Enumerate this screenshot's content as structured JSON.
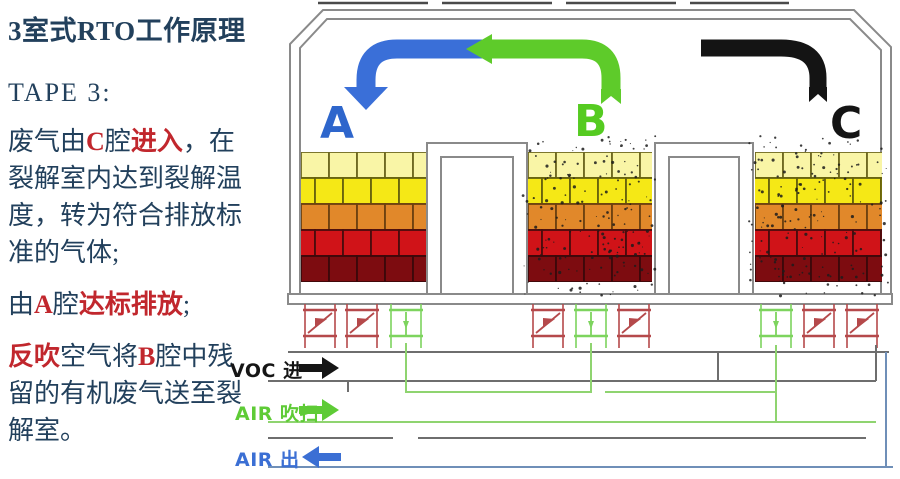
{
  "panel": {
    "title": "3室式RTO工作原理",
    "tape": "TAPE 3:",
    "paragraphs": [
      [
        {
          "t": "废气由"
        },
        {
          "t": "C",
          "red": true
        },
        {
          "t": "腔"
        },
        {
          "t": "进入",
          "red": true
        },
        {
          "t": "，在裂解室内达到裂解温度，转为符合排放标准的气体;"
        }
      ],
      [
        {
          "t": "由"
        },
        {
          "t": "A",
          "red": true
        },
        {
          "t": "腔"
        },
        {
          "t": "达标排放",
          "red": true
        },
        {
          "t": ";"
        }
      ],
      [
        {
          "t": "反吹",
          "red": true
        },
        {
          "t": "空气将"
        },
        {
          "t": "B",
          "red": true
        },
        {
          "t": "腔中残留的有机废气送至裂解室。"
        }
      ]
    ]
  },
  "chambers": [
    {
      "label": "A",
      "color": "#2e66cc",
      "valves": [
        "red",
        "red",
        "green"
      ],
      "dirty": false
    },
    {
      "label": "B",
      "color": "#55cb21",
      "valves": [
        "red",
        "green",
        "red"
      ],
      "dirty": true
    },
    {
      "label": "C",
      "color": "#141414",
      "valves": [
        "green",
        "red",
        "red"
      ],
      "dirty": true
    }
  ],
  "flows": [
    {
      "label": "VOC 进",
      "color": "#151515",
      "dir": "right"
    },
    {
      "label": "AIR 吹扫",
      "color": "#5ecb36",
      "dir": "right"
    },
    {
      "label": "AIR 出",
      "color": "#3b6fd4",
      "dir": "left"
    }
  ],
  "brick_layers": [
    {
      "fill": "#f9f5a6",
      "stroke": "#6e6820"
    },
    {
      "fill": "#f5e816",
      "stroke": "#67620d"
    },
    {
      "fill": "#e1882a",
      "stroke": "#6d4110"
    },
    {
      "fill": "#d01318",
      "stroke": "#4a0c0d"
    },
    {
      "fill": "#7d0c10",
      "stroke": "#3c080a"
    }
  ],
  "colors": {
    "text_navy": "#22405c",
    "text_red": "#c1272d",
    "arrow_blue": "#3a6fd8",
    "arrow_green": "#5ecb2a",
    "arrow_black": "#141414",
    "wall_gray": "#8a8a8a",
    "pipe_gray": "#6e6e6e",
    "pipe_green": "#8fd470",
    "pipe_blue": "#6f8fb8",
    "valve_red": "#b5494b",
    "valve_green": "#7dd45e",
    "speckle": "#1c1c1c"
  }
}
